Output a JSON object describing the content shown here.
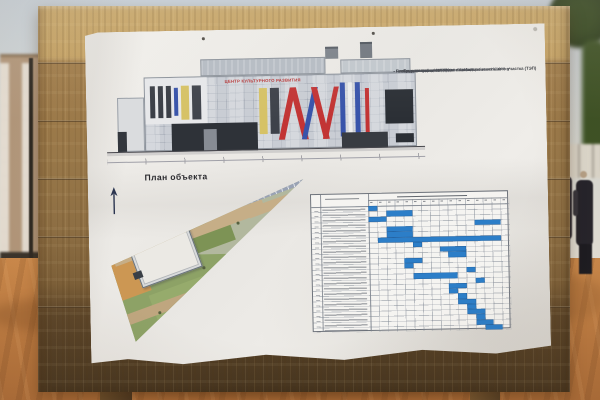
{
  "scene": {
    "colors": {
      "sky": "#c6cfd7",
      "sand": "#c57f42",
      "wood_light": "#c7a567",
      "wood_dark": "#44331e",
      "paper": "#edebe7",
      "gantt_bar": "#2c7ec8",
      "accent_red": "#b82f2f",
      "accent_blue": "#3854aa",
      "accent_yellow": "#d6c266"
    }
  },
  "poster": {
    "elevation": {
      "sign_text": "ЦЕНТР КУЛЬТУРНОГО РАЗВИТИЯ",
      "stripes": [
        {
          "x": 0,
          "y": 0,
          "w": 62,
          "h": 46,
          "c": "#e7e8ea"
        },
        {
          "x": 5,
          "y": 8,
          "w": 5,
          "h": 32,
          "c": "#3a3e46"
        },
        {
          "x": 13,
          "y": 8,
          "w": 5,
          "h": 32,
          "c": "#3a3e46"
        },
        {
          "x": 21,
          "y": 8,
          "w": 5,
          "h": 32,
          "c": "#3a3e46"
        },
        {
          "x": 29,
          "y": 10,
          "w": 4,
          "h": 28,
          "c": "#3854aa"
        },
        {
          "x": 36,
          "y": 8,
          "w": 8,
          "h": 34,
          "c": "#d6c266"
        },
        {
          "x": 47,
          "y": 8,
          "w": 9,
          "h": 34,
          "c": "#40444c"
        },
        {
          "x": 26,
          "y": 46,
          "w": 86,
          "h": 28,
          "c": "#2e3238"
        },
        {
          "x": 58,
          "y": 52,
          "w": 13,
          "h": 22,
          "c": "#878c94"
        },
        {
          "x": 114,
          "y": 12,
          "w": 8,
          "h": 46,
          "c": "#d6c266"
        },
        {
          "x": 125,
          "y": 12,
          "w": 9,
          "h": 46,
          "c": "#3e424a"
        },
        {
          "x": 139,
          "y": 12,
          "w": 6,
          "h": 52,
          "c": "#c23434",
          "sk": -13
        },
        {
          "x": 151,
          "y": 12,
          "w": 6,
          "h": 52,
          "c": "#c23434",
          "sk": 13
        },
        {
          "x": 162,
          "y": 12,
          "w": 5,
          "h": 52,
          "c": "#3854aa",
          "sk": -13
        },
        {
          "x": 172,
          "y": 12,
          "w": 6,
          "h": 52,
          "c": "#c23434",
          "sk": 13
        },
        {
          "x": 183,
          "y": 12,
          "w": 5,
          "h": 52,
          "c": "#c23434",
          "sk": -13
        },
        {
          "x": 195,
          "y": 8,
          "w": 5,
          "h": 54,
          "c": "#3854aa"
        },
        {
          "x": 203,
          "y": 8,
          "w": 4,
          "h": 54,
          "c": "#eceded"
        },
        {
          "x": 210,
          "y": 8,
          "w": 5,
          "h": 54,
          "c": "#3854aa"
        },
        {
          "x": 220,
          "y": 14,
          "w": 4,
          "h": 48,
          "c": "#c23434"
        },
        {
          "x": 240,
          "y": 16,
          "w": 28,
          "h": 34,
          "c": "#2b2f35"
        },
        {
          "x": 196,
          "y": 58,
          "w": 46,
          "h": 16,
          "c": "#383c42"
        },
        {
          "x": 250,
          "y": 60,
          "w": 18,
          "h": 9,
          "c": "#2b2f35"
        }
      ]
    },
    "tep": {
      "title": "Технико-экономические показатели земельного участка (ТЭП)",
      "items": [
        "- Площадь участка = 6211 м²",
        "- Площадь застройки = 1195 м²",
        "- Площадь озеленения = 1086 м²",
        "   - площадь газонов = 891 м²",
        "   - площадь пешеходных дорожек и велодорожек = 195 м²",
        "- Площадь проездов и площадок из асфальтобетона = 1046 м²",
        "- Площадь тротуаров и отмостки = 1179 м²",
        "- Количество парковочных мест = 24 м/мест"
      ]
    },
    "site_plan": {
      "title": "План объекта"
    }
  },
  "chart_data": {
    "type": "gantt",
    "columns": 16,
    "rows": 24,
    "bar_color": "#2c7ec8",
    "bars": [
      {
        "row": 1,
        "col": 1,
        "span": 1
      },
      {
        "row": 2,
        "col": 3,
        "span": 3
      },
      {
        "row": 3,
        "col": 1,
        "span": 2
      },
      {
        "row": 4,
        "col": 13,
        "span": 3
      },
      {
        "row": 5,
        "col": 3,
        "span": 3
      },
      {
        "row": 6,
        "col": 3,
        "span": 3
      },
      {
        "row": 7,
        "col": 2,
        "span": 14
      },
      {
        "row": 8,
        "col": 6,
        "span": 1
      },
      {
        "row": 9,
        "col": 9,
        "span": 3
      },
      {
        "row": 10,
        "col": 10,
        "span": 2
      },
      {
        "row": 11,
        "col": 5,
        "span": 2
      },
      {
        "row": 12,
        "col": 5,
        "span": 1
      },
      {
        "row": 13,
        "col": 12,
        "span": 1
      },
      {
        "row": 14,
        "col": 6,
        "span": 5
      },
      {
        "row": 15,
        "col": 13,
        "span": 1
      },
      {
        "row": 16,
        "col": 10,
        "span": 2
      },
      {
        "row": 17,
        "col": 10,
        "span": 1
      },
      {
        "row": 18,
        "col": 11,
        "span": 1
      },
      {
        "row": 19,
        "col": 11,
        "span": 2
      },
      {
        "row": 20,
        "col": 12,
        "span": 1
      },
      {
        "row": 21,
        "col": 12,
        "span": 2
      },
      {
        "row": 22,
        "col": 13,
        "span": 1
      },
      {
        "row": 23,
        "col": 13,
        "span": 2
      },
      {
        "row": 24,
        "col": 14,
        "span": 2
      }
    ]
  }
}
